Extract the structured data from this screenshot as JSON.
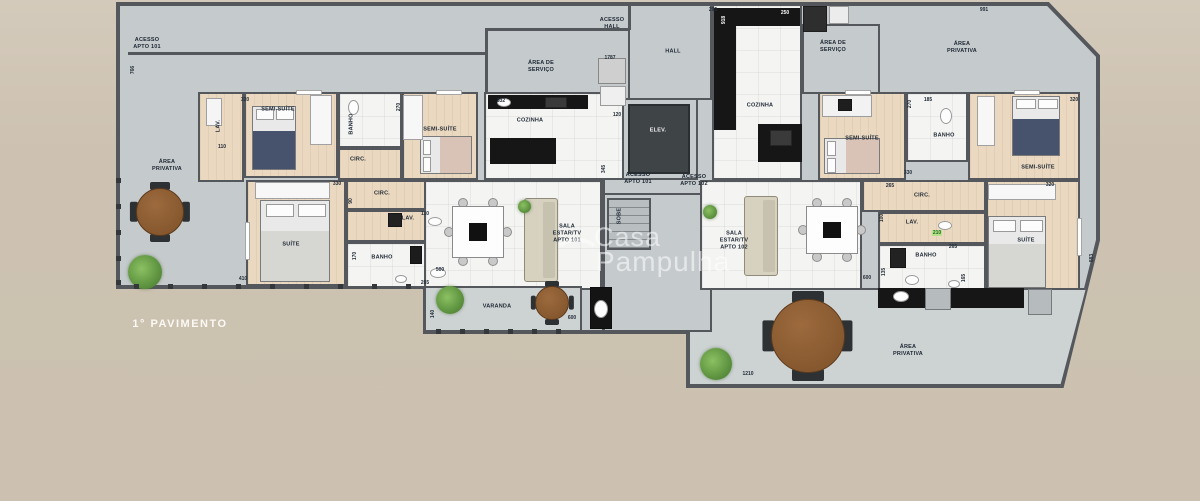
{
  "meta": {
    "title": "1° PAVIMENTO",
    "watermark_line1": "Casa",
    "watermark_line2": "Pampulha"
  },
  "colors": {
    "background": "#cdc2b1",
    "floor_gray": "#c5cacc",
    "wall": "#54585c",
    "wood_floor": "#ead9c0",
    "white_floor": "#f4f4f2",
    "counter_dark": "#161616",
    "elevator": "#3f4447",
    "table_brown": "#8a5a33",
    "plant_green": "#69a14e",
    "label_text": "#1d2733",
    "highlight_green": "#b7e08a"
  },
  "outline": {
    "points": "118,4 1048,4 1098,56 1098,240 1062,386 688,386 688,332 425,332 425,287 118,287",
    "terrace_clip": "polygon(0 0,100% 0,93.5% 100%,0 100%)"
  },
  "rooms": [
    {
      "id": "hall",
      "x": 628,
      "y": 4,
      "w": 84,
      "h": 96,
      "floor": "gray"
    },
    {
      "id": "elevator-shaft",
      "x": 620,
      "y": 98,
      "w": 78,
      "h": 82,
      "floor": "gray"
    },
    {
      "id": "stairs-block",
      "x": 602,
      "y": 193,
      "w": 110,
      "h": 139,
      "floor": "gray"
    },
    {
      "id": "lav-101a",
      "x": 198,
      "y": 92,
      "w": 46,
      "h": 90,
      "floor": "wood"
    },
    {
      "id": "semi-suite-1",
      "x": 244,
      "y": 92,
      "w": 94,
      "h": 86,
      "floor": "wood"
    },
    {
      "id": "banho-1",
      "x": 338,
      "y": 92,
      "w": 64,
      "h": 56,
      "floor": "white"
    },
    {
      "id": "circ-1",
      "x": 338,
      "y": 148,
      "w": 64,
      "h": 32,
      "floor": "wood"
    },
    {
      "id": "semi-suite-2",
      "x": 402,
      "y": 92,
      "w": 76,
      "h": 88,
      "floor": "wood"
    },
    {
      "id": "cozinha-101",
      "x": 484,
      "y": 92,
      "w": 140,
      "h": 88,
      "floor": "white"
    },
    {
      "id": "suite-101",
      "x": 246,
      "y": 180,
      "w": 100,
      "h": 106,
      "floor": "wood"
    },
    {
      "id": "circ-2",
      "x": 346,
      "y": 180,
      "w": 124,
      "h": 30,
      "floor": "wood"
    },
    {
      "id": "lav-101b",
      "x": 346,
      "y": 210,
      "w": 124,
      "h": 32,
      "floor": "wood"
    },
    {
      "id": "banho-101",
      "x": 346,
      "y": 242,
      "w": 124,
      "h": 46,
      "floor": "white"
    },
    {
      "id": "sala-101",
      "x": 424,
      "y": 180,
      "w": 178,
      "h": 110,
      "floor": "white"
    },
    {
      "id": "cozinha-102",
      "x": 712,
      "y": 4,
      "w": 90,
      "h": 176,
      "floor": "white"
    },
    {
      "id": "area-servico-102",
      "x": 802,
      "y": 24,
      "w": 78,
      "h": 70,
      "floor": "gray"
    },
    {
      "id": "semi-suite-3",
      "x": 818,
      "y": 92,
      "w": 88,
      "h": 88,
      "floor": "wood"
    },
    {
      "id": "banho-102a",
      "x": 906,
      "y": 92,
      "w": 62,
      "h": 70,
      "floor": "white"
    },
    {
      "id": "semi-suite-4",
      "x": 968,
      "y": 92,
      "w": 112,
      "h": 88,
      "floor": "wood"
    },
    {
      "id": "circ-102",
      "x": 862,
      "y": 180,
      "w": 124,
      "h": 32,
      "floor": "wood"
    },
    {
      "id": "lav-102",
      "x": 878,
      "y": 212,
      "w": 108,
      "h": 32,
      "floor": "wood"
    },
    {
      "id": "banho-102b",
      "x": 878,
      "y": 244,
      "w": 108,
      "h": 52,
      "floor": "white"
    },
    {
      "id": "suite-102",
      "x": 986,
      "y": 180,
      "w": 94,
      "h": 110,
      "floor": "wood"
    },
    {
      "id": "sala-102",
      "x": 700,
      "y": 180,
      "w": 162,
      "h": 110,
      "floor": "white"
    },
    {
      "id": "varanda",
      "x": 424,
      "y": 286,
      "w": 158,
      "h": 46,
      "floor": "terrace"
    }
  ],
  "terrace_br": {
    "x": 688,
    "y": 288,
    "w": 398,
    "h": 98
  },
  "walls": [
    {
      "x": 128,
      "y": 52,
      "w": 358,
      "h": 3
    },
    {
      "x": 485,
      "y": 28,
      "w": 145,
      "h": 3
    },
    {
      "x": 485,
      "y": 28,
      "w": 3,
      "h": 66
    },
    {
      "x": 628,
      "y": 4,
      "w": 3,
      "h": 26
    },
    {
      "x": 602,
      "y": 180,
      "w": 3,
      "h": 152
    }
  ],
  "labels": [
    {
      "id": "acesso-apto-101-top",
      "text": "ACESSO\nAPTO 101",
      "x": 147,
      "y": 44
    },
    {
      "id": "acesso-hall",
      "text": "ACESSO\nHALL",
      "x": 612,
      "y": 24
    },
    {
      "id": "hall",
      "text": "HALL",
      "x": 673,
      "y": 52
    },
    {
      "id": "area-servico-101",
      "text": "ÁREA DE\nSERVIÇO",
      "x": 541,
      "y": 67
    },
    {
      "id": "cozinha-101",
      "text": "COZINHA",
      "x": 530,
      "y": 121
    },
    {
      "id": "elevador",
      "text": "ELEV.",
      "x": 658,
      "y": 131,
      "white": true
    },
    {
      "id": "acesso-apto-101",
      "text": "ACESSO\nAPTO 101",
      "x": 638,
      "y": 179
    },
    {
      "id": "acesso-apto-102",
      "text": "ACESSO\nAPTO 102",
      "x": 694,
      "y": 181
    },
    {
      "id": "sobe",
      "text": "SOBE",
      "x": 620,
      "y": 216,
      "vert": true
    },
    {
      "id": "cozinha-102",
      "text": "COZINHA",
      "x": 760,
      "y": 106
    },
    {
      "id": "area-servico-102",
      "text": "ÁREA DE\nSERVIÇO",
      "x": 833,
      "y": 47
    },
    {
      "id": "area-privativa-top-right",
      "text": "ÁREA\nPRIVATIVA",
      "x": 962,
      "y": 48
    },
    {
      "id": "area-privativa-left",
      "text": "ÁREA\nPRIVATIVA",
      "x": 167,
      "y": 166
    },
    {
      "id": "area-privativa-bottom-right",
      "text": "ÁREA\nPRIVATIVA",
      "x": 908,
      "y": 351
    },
    {
      "id": "semi-suite-1",
      "text": "SEMI-SUÍTE",
      "x": 278,
      "y": 110
    },
    {
      "id": "banho-1",
      "text": "BANHO",
      "x": 352,
      "y": 124,
      "vert": true
    },
    {
      "id": "semi-suite-2",
      "text": "SEMI-SUÍTE",
      "x": 440,
      "y": 130
    },
    {
      "id": "lav-101a",
      "text": "LAV.",
      "x": 219,
      "y": 126,
      "vert": true
    },
    {
      "id": "circ-1",
      "text": "CIRC.",
      "x": 358,
      "y": 160
    },
    {
      "id": "suite-101",
      "text": "SUÍTE",
      "x": 291,
      "y": 245
    },
    {
      "id": "circ-2",
      "text": "CIRC.",
      "x": 382,
      "y": 194
    },
    {
      "id": "lav-101b",
      "text": "LAV.",
      "x": 408,
      "y": 219
    },
    {
      "id": "banho-101",
      "text": "BANHO",
      "x": 382,
      "y": 258
    },
    {
      "id": "sala-101",
      "text": "SALA\nESTAR/TV\nAPTO 101",
      "x": 567,
      "y": 234
    },
    {
      "id": "semi-suite-3",
      "text": "SEMI-SUÍTE",
      "x": 862,
      "y": 139
    },
    {
      "id": "banho-102a",
      "text": "BANHO",
      "x": 944,
      "y": 136
    },
    {
      "id": "semi-suite-4",
      "text": "SEMI-SUÍTE",
      "x": 1038,
      "y": 168
    },
    {
      "id": "circ-102",
      "text": "CIRC.",
      "x": 922,
      "y": 196
    },
    {
      "id": "lav-102",
      "text": "LAV.",
      "x": 912,
      "y": 223
    },
    {
      "id": "banho-102b",
      "text": "BANHO",
      "x": 926,
      "y": 256
    },
    {
      "id": "suite-102",
      "text": "SUÍTE",
      "x": 1026,
      "y": 241
    },
    {
      "id": "sala-102",
      "text": "SALA\nESTAR/TV\nAPTO 102",
      "x": 734,
      "y": 241
    },
    {
      "id": "varanda",
      "text": "VARANDA",
      "x": 497,
      "y": 307
    }
  ],
  "dims": [
    {
      "t": "766",
      "x": 133,
      "y": 70,
      "vert": true
    },
    {
      "t": "991",
      "x": 984,
      "y": 10
    },
    {
      "t": "883",
      "x": 1092,
      "y": 258,
      "vert": true
    },
    {
      "t": "1210",
      "x": 748,
      "y": 374
    },
    {
      "t": "295",
      "x": 713,
      "y": 10
    },
    {
      "t": "250",
      "x": 785,
      "y": 13,
      "white": true
    },
    {
      "t": "918",
      "x": 724,
      "y": 20,
      "vert": true,
      "white": true
    },
    {
      "t": "1787",
      "x": 610,
      "y": 58
    },
    {
      "t": "332",
      "x": 501,
      "y": 101
    },
    {
      "t": "120",
      "x": 617,
      "y": 115
    },
    {
      "t": "320",
      "x": 245,
      "y": 100
    },
    {
      "t": "270",
      "x": 399,
      "y": 107,
      "vert": true
    },
    {
      "t": "110",
      "x": 222,
      "y": 147
    },
    {
      "t": "330",
      "x": 337,
      "y": 184
    },
    {
      "t": "90",
      "x": 351,
      "y": 201,
      "vert": true
    },
    {
      "t": "110",
      "x": 425,
      "y": 214
    },
    {
      "t": "170",
      "x": 355,
      "y": 256,
      "vert": true
    },
    {
      "t": "265",
      "x": 425,
      "y": 283
    },
    {
      "t": "410",
      "x": 243,
      "y": 279
    },
    {
      "t": "500",
      "x": 440,
      "y": 270
    },
    {
      "t": "345",
      "x": 604,
      "y": 169,
      "vert": true
    },
    {
      "t": "140",
      "x": 433,
      "y": 314,
      "vert": true
    },
    {
      "t": "600",
      "x": 572,
      "y": 318
    },
    {
      "t": "265",
      "x": 890,
      "y": 186
    },
    {
      "t": "100",
      "x": 882,
      "y": 218,
      "vert": true
    },
    {
      "t": "210",
      "x": 937,
      "y": 233,
      "green": true
    },
    {
      "t": "135",
      "x": 884,
      "y": 272,
      "vert": true
    },
    {
      "t": "265",
      "x": 953,
      "y": 247
    },
    {
      "t": "600",
      "x": 867,
      "y": 278
    },
    {
      "t": "165",
      "x": 964,
      "y": 278,
      "vert": true
    },
    {
      "t": "320",
      "x": 1050,
      "y": 185
    },
    {
      "t": "330",
      "x": 908,
      "y": 173
    },
    {
      "t": "270",
      "x": 910,
      "y": 104,
      "vert": true
    },
    {
      "t": "185",
      "x": 928,
      "y": 100
    },
    {
      "t": "320",
      "x": 1074,
      "y": 100
    }
  ],
  "furniture": {
    "counters": [
      {
        "x": 488,
        "y": 95,
        "w": 100,
        "h": 14
      },
      {
        "x": 490,
        "y": 138,
        "w": 66,
        "h": 26
      },
      {
        "x": 714,
        "y": 8,
        "w": 22,
        "h": 122
      },
      {
        "x": 736,
        "y": 8,
        "w": 64,
        "h": 18
      },
      {
        "x": 758,
        "y": 124,
        "w": 44,
        "h": 38
      },
      {
        "x": 878,
        "y": 288,
        "w": 146,
        "h": 20
      }
    ],
    "elevator_box": {
      "x": 628,
      "y": 104,
      "w": 62,
      "h": 70
    },
    "stairs": {
      "x": 607,
      "y": 198,
      "w": 44,
      "h": 52
    },
    "beds": [
      {
        "x": 252,
        "y": 106,
        "w": 44,
        "h": 64,
        "dir": "v",
        "blanket": "#47536d"
      },
      {
        "x": 420,
        "y": 136,
        "w": 52,
        "h": 38,
        "dir": "h",
        "blanket": "#d9c2b6"
      },
      {
        "x": 824,
        "y": 138,
        "w": 56,
        "h": 36,
        "dir": "h",
        "blanket": "#d9c2b6"
      },
      {
        "x": 1012,
        "y": 96,
        "w": 48,
        "h": 60,
        "dir": "v",
        "blanket": "#47536d"
      },
      {
        "x": 260,
        "y": 200,
        "w": 70,
        "h": 82,
        "dir": "v",
        "blanket": "#d6d6d3"
      },
      {
        "x": 988,
        "y": 216,
        "w": 58,
        "h": 72,
        "dir": "v",
        "blanket": "#d6d6d3"
      }
    ],
    "round_tables": [
      {
        "cx": 160,
        "cy": 212,
        "d": 48
      },
      {
        "cx": 552,
        "cy": 303,
        "d": 34
      },
      {
        "cx": 808,
        "cy": 336,
        "d": 74
      }
    ],
    "dining_tables": [
      {
        "x": 452,
        "y": 206,
        "w": 52,
        "h": 52
      },
      {
        "x": 806,
        "y": 206,
        "w": 52,
        "h": 48
      }
    ],
    "sofas": [
      {
        "x": 524,
        "y": 198,
        "w": 34,
        "h": 84
      },
      {
        "x": 744,
        "y": 196,
        "w": 34,
        "h": 80
      }
    ],
    "plants": [
      {
        "cx": 145,
        "cy": 272,
        "d": 34
      },
      {
        "cx": 450,
        "cy": 300,
        "d": 28
      },
      {
        "cx": 716,
        "cy": 364,
        "d": 32
      },
      {
        "cx": 710,
        "cy": 212,
        "d": 14
      },
      {
        "cx": 524,
        "cy": 206,
        "d": 13
      }
    ],
    "boxes": [
      {
        "x": 598,
        "y": 58,
        "w": 28,
        "h": 26,
        "c": "#cfcfcf"
      },
      {
        "x": 600,
        "y": 86,
        "w": 26,
        "h": 20,
        "c": "#efefef"
      },
      {
        "x": 803,
        "y": 6,
        "w": 24,
        "h": 26,
        "c": "#2e2e2e"
      },
      {
        "x": 829,
        "y": 6,
        "w": 20,
        "h": 18,
        "c": "#ececec"
      },
      {
        "x": 925,
        "y": 288,
        "w": 26,
        "h": 22,
        "c": "#b6bbbd"
      },
      {
        "x": 1028,
        "y": 289,
        "w": 24,
        "h": 26,
        "c": "#b6bbbd"
      },
      {
        "x": 590,
        "y": 287,
        "w": 22,
        "h": 42,
        "c": "#141414"
      },
      {
        "x": 310,
        "y": 95,
        "w": 22,
        "h": 50,
        "c": "#f7f7f7"
      },
      {
        "x": 403,
        "y": 95,
        "w": 20,
        "h": 45,
        "c": "#f7f7f7"
      },
      {
        "x": 255,
        "y": 182,
        "w": 75,
        "h": 17,
        "c": "#f7f7f7"
      },
      {
        "x": 977,
        "y": 96,
        "w": 18,
        "h": 50,
        "c": "#f7f7f7"
      },
      {
        "x": 988,
        "y": 184,
        "w": 68,
        "h": 16,
        "c": "#f7f7f7"
      },
      {
        "x": 822,
        "y": 95,
        "w": 50,
        "h": 22,
        "c": "#f2f2f2"
      },
      {
        "x": 838,
        "y": 99,
        "w": 14,
        "h": 12,
        "c": "#1e1e1e"
      },
      {
        "x": 388,
        "y": 213,
        "w": 14,
        "h": 14,
        "c": "#222222"
      },
      {
        "x": 410,
        "y": 246,
        "w": 12,
        "h": 18,
        "c": "#1c1c1c"
      },
      {
        "x": 890,
        "y": 248,
        "w": 16,
        "h": 20,
        "c": "#222222"
      },
      {
        "x": 545,
        "y": 97,
        "w": 22,
        "h": 11,
        "c": "#3a3a3a"
      },
      {
        "x": 770,
        "y": 130,
        "w": 22,
        "h": 16,
        "c": "#3a3a3a"
      },
      {
        "x": 296,
        "y": 90,
        "w": 26,
        "h": 5,
        "c": "#ffffff"
      },
      {
        "x": 436,
        "y": 90,
        "w": 26,
        "h": 5,
        "c": "#ffffff"
      },
      {
        "x": 845,
        "y": 90,
        "w": 26,
        "h": 5,
        "c": "#ffffff"
      },
      {
        "x": 1014,
        "y": 90,
        "w": 26,
        "h": 5,
        "c": "#ffffff"
      },
      {
        "x": 245,
        "y": 222,
        "w": 5,
        "h": 38,
        "c": "#ffffff"
      },
      {
        "x": 1077,
        "y": 218,
        "w": 5,
        "h": 38,
        "c": "#ffffff"
      },
      {
        "x": 206,
        "y": 98,
        "w": 16,
        "h": 28,
        "c": "#f5f5f5"
      }
    ],
    "ovals": [
      {
        "x": 348,
        "y": 100,
        "w": 11,
        "h": 15
      },
      {
        "x": 430,
        "y": 268,
        "w": 16,
        "h": 10
      },
      {
        "x": 395,
        "y": 275,
        "w": 12,
        "h": 8
      },
      {
        "x": 428,
        "y": 217,
        "w": 14,
        "h": 9
      },
      {
        "x": 940,
        "y": 108,
        "w": 12,
        "h": 16
      },
      {
        "x": 905,
        "y": 275,
        "w": 14,
        "h": 10
      },
      {
        "x": 948,
        "y": 280,
        "w": 12,
        "h": 8
      },
      {
        "x": 938,
        "y": 221,
        "w": 14,
        "h": 9
      },
      {
        "x": 893,
        "y": 291,
        "w": 16,
        "h": 11
      },
      {
        "x": 497,
        "y": 98,
        "w": 14,
        "h": 9
      },
      {
        "x": 594,
        "y": 300,
        "w": 14,
        "h": 18
      }
    ],
    "dots": {
      "left_x": 116,
      "left_ys": [
        178,
        204,
        230,
        256,
        280
      ],
      "bottom_y": 284,
      "bottom_xs": [
        134,
        168,
        202,
        236,
        270,
        304,
        338,
        372,
        406
      ],
      "varanda_y": 329,
      "varanda_xs": [
        436,
        460,
        484,
        508,
        532,
        556
      ]
    }
  }
}
